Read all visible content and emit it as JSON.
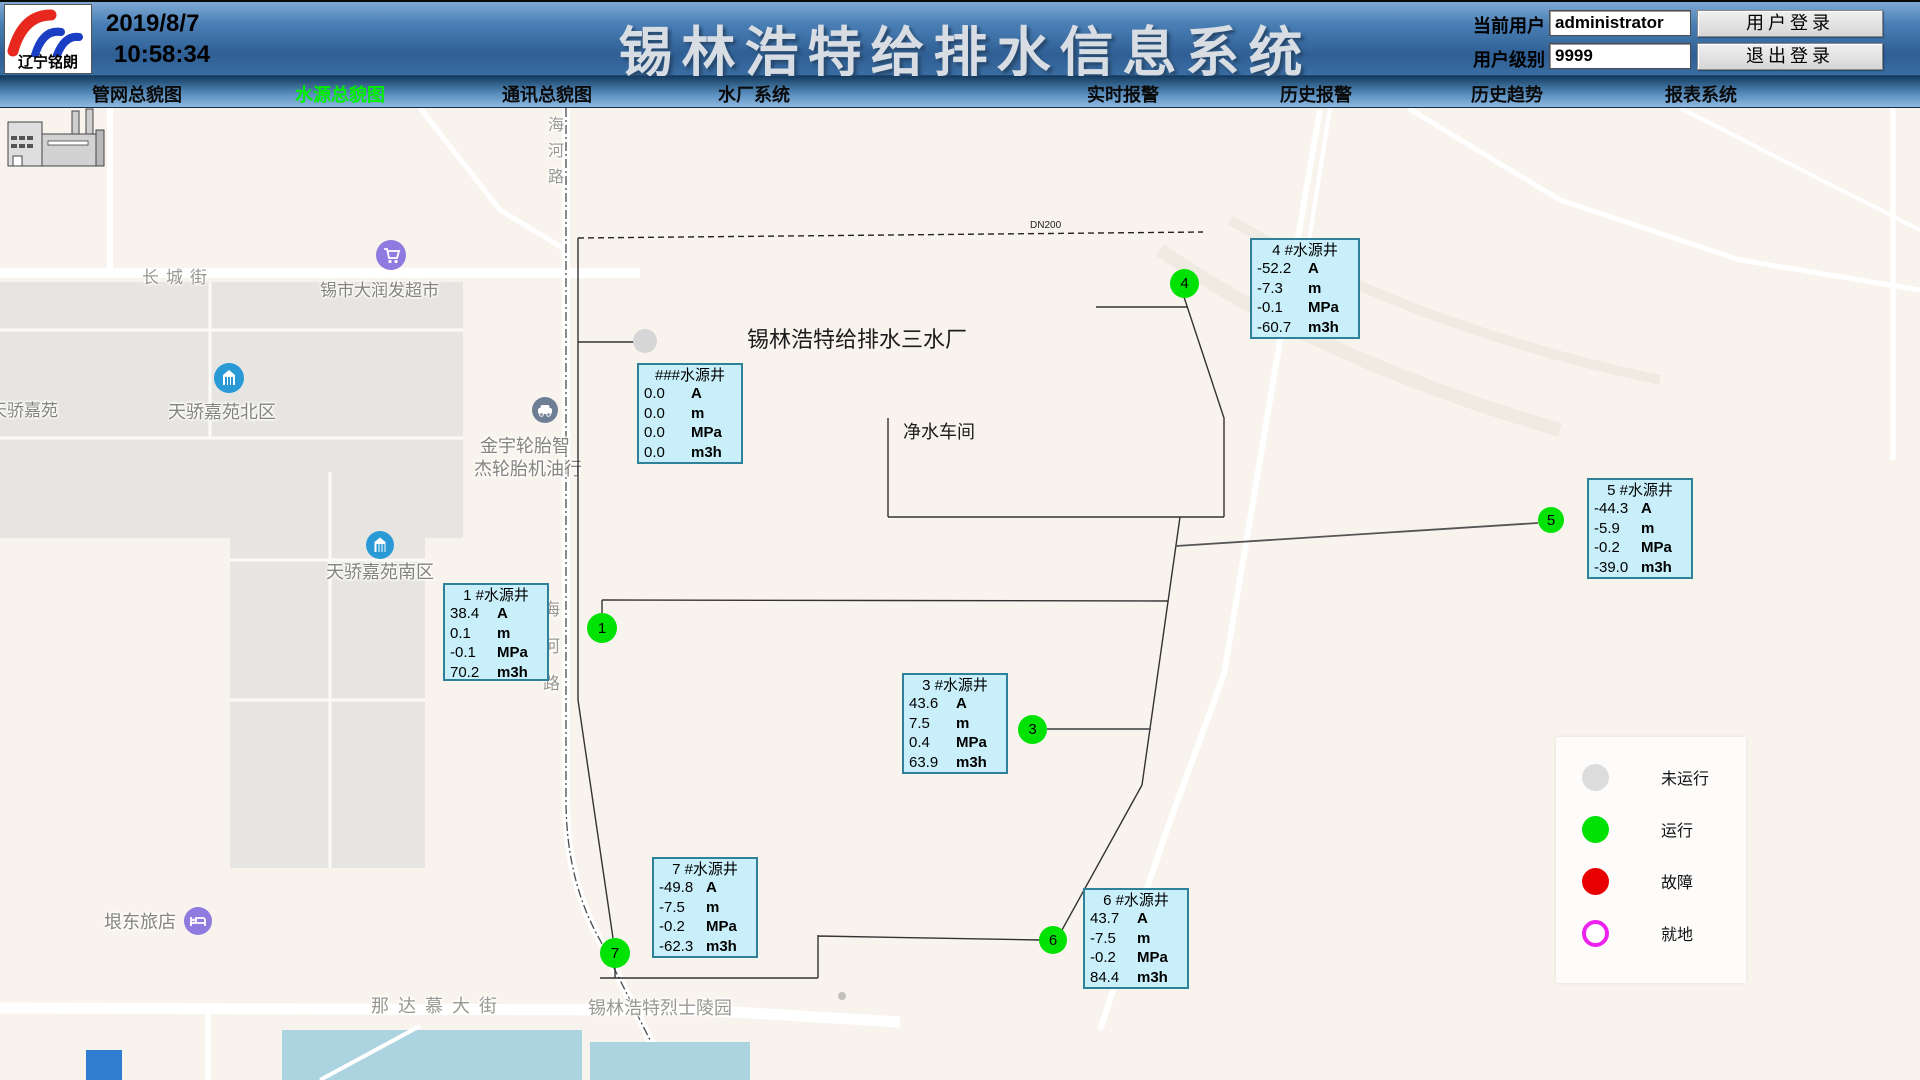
{
  "header": {
    "logo_text": "辽宁铭朗",
    "date": "2019/8/7",
    "time": "10:58:34",
    "title": "锡林浩特给排水信息系统",
    "current_user_label": "当前用户",
    "current_user_value": "administrator",
    "user_level_label": "用户级别",
    "user_level_value": "9999",
    "login_button": "用户登录",
    "logout_button": "退出登录"
  },
  "nav": {
    "items": [
      {
        "label": "管网总貌图",
        "active": false
      },
      {
        "label": "水源总貌图",
        "active": true
      },
      {
        "label": "通讯总貌图",
        "active": false
      },
      {
        "label": "水厂系统",
        "active": false
      },
      {
        "label": "实时报警",
        "active": false
      },
      {
        "label": "历史报警",
        "active": false
      },
      {
        "label": "历史趋势",
        "active": false
      },
      {
        "label": "报表系统",
        "active": false
      }
    ]
  },
  "map": {
    "plant_title": "锡林浩特给排水三水厂",
    "workshop_label": "净水车间",
    "pipe_label": "DN200",
    "streets": {
      "changcheng": "长城街",
      "haihe": [
        "海",
        "河",
        "路"
      ],
      "nadamu": "那达慕大街",
      "martyrs_park": "锡林浩特烈士陵园"
    },
    "pois": {
      "supermarket": "锡市大润发超市",
      "tianjiao": "天骄嘉苑",
      "north_block": "天骄嘉苑北区",
      "south_block": "天骄嘉苑南区",
      "tire_shop_line1": "金宇轮胎智",
      "tire_shop_line2": "杰轮胎机油行",
      "hotel": "垠东旅店"
    }
  },
  "wells": {
    "units": [
      "A",
      "m",
      "MPa",
      "m3h"
    ],
    "list": [
      {
        "title": "###水源井",
        "marker": "",
        "status": "未运行",
        "values": [
          "0.0",
          "0.0",
          "0.0",
          "0.0"
        ]
      },
      {
        "title": "1 #水源井",
        "marker": "1",
        "status": "运行",
        "values": [
          "38.4",
          "0.1",
          "-0.1",
          "70.2"
        ]
      },
      {
        "title": "3 #水源井",
        "marker": "3",
        "status": "运行",
        "values": [
          "43.6",
          "7.5",
          "0.4",
          "63.9"
        ]
      },
      {
        "title": "4 #水源井",
        "marker": "4",
        "status": "运行",
        "values": [
          "-52.2",
          "-7.3",
          "-0.1",
          "-60.7"
        ]
      },
      {
        "title": "5 #水源井",
        "marker": "5",
        "status": "运行",
        "values": [
          "-44.3",
          "-5.9",
          "-0.2",
          "-39.0"
        ]
      },
      {
        "title": "6 #水源井",
        "marker": "6",
        "status": "运行",
        "values": [
          "43.7",
          "-7.5",
          "-0.2",
          "84.4"
        ]
      },
      {
        "title": "7 #水源井",
        "marker": "7",
        "status": "运行",
        "values": [
          "-49.8",
          "-7.5",
          "-0.2",
          "-62.3"
        ]
      }
    ]
  },
  "legend": {
    "items": [
      {
        "label": "未运行",
        "color": "#dcdcdc"
      },
      {
        "label": "运行",
        "color": "#00e104"
      },
      {
        "label": "故障",
        "color": "#e80000"
      },
      {
        "label": "就地",
        "color": "#ee22ee"
      }
    ]
  }
}
